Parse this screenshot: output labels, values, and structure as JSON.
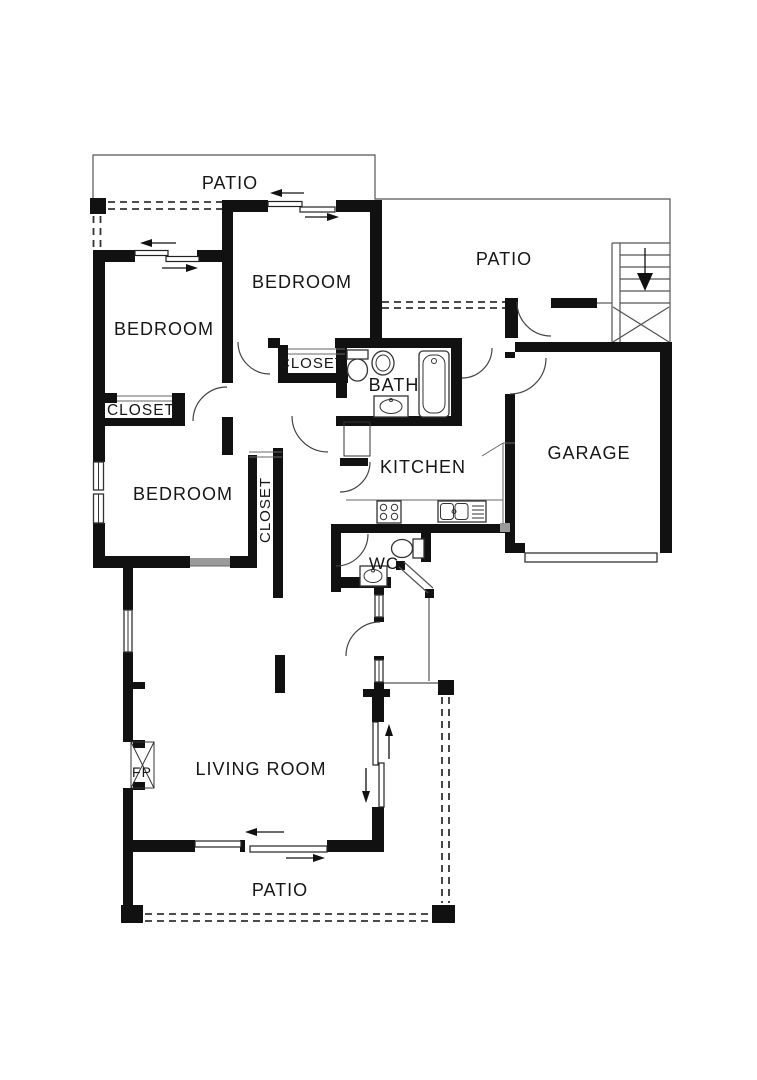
{
  "figure": {
    "kind": "architectural-floor-plan"
  },
  "labels": {
    "patio_top_left": "PATIO",
    "patio_top_right": "PATIO",
    "patio_bottom": "PATIO",
    "bedroom_top": "BEDROOM",
    "bedroom_upper_left": "BEDROOM",
    "bedroom_lower_left": "BEDROOM",
    "closet_upper_left": "CLOSET",
    "closet_hall": "CLOSET",
    "closet_bedroom": "CLOSET",
    "bath": "BATH",
    "kitchen": "KITCHEN",
    "garage": "GARAGE",
    "wc": "WC",
    "fireplace": "FP",
    "living_room": "LIVING ROOM"
  },
  "colors": {
    "walls": "#111111",
    "thin_lines": "#555555",
    "dashed_lines": "#333333",
    "background": "#ffffff"
  }
}
